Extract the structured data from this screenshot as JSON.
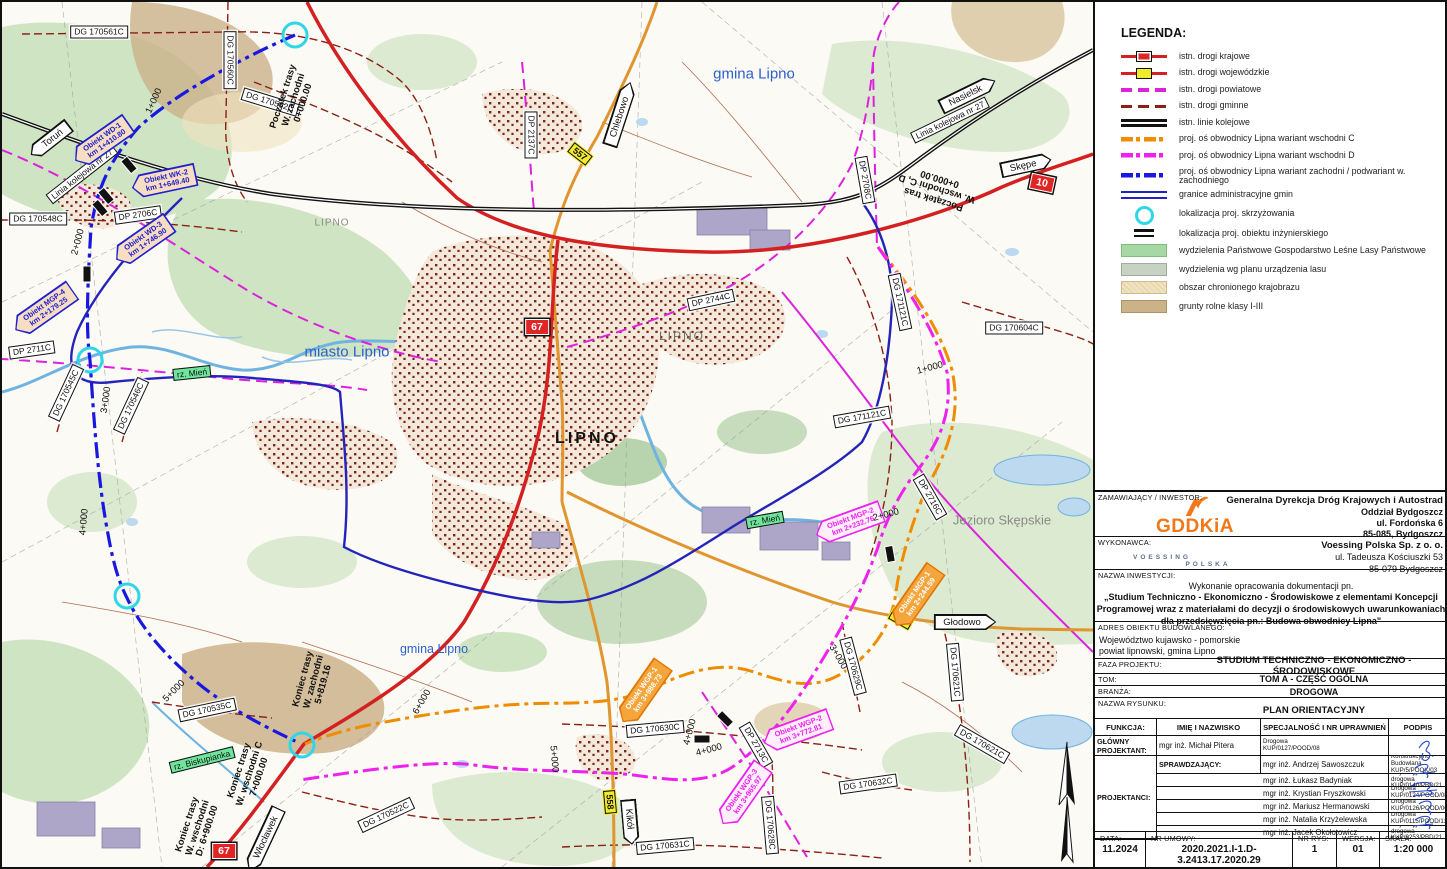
{
  "legend": {
    "title": "LEGENDA:",
    "items": [
      {
        "label": "istn. drogi krajowe"
      },
      {
        "label": "istn. drogi wojewódzkie"
      },
      {
        "label": "istn. drogi powiatowe"
      },
      {
        "label": "istn. drogi gminne"
      },
      {
        "label": "istn. linie kolejowe"
      },
      {
        "label": "proj. oś obwodnicy Lipna wariant wschodni C"
      },
      {
        "label": "proj. oś obwodnicy Lipna wariant wschodni D"
      },
      {
        "label": "proj. oś obwodnicy Lipna wariant zachodni / podwariant w. zachodniego"
      },
      {
        "label": "granice administracyjne gmin"
      },
      {
        "label": "lokalizacja proj. skrzyżowania"
      },
      {
        "label": "lokalizacja proj. obiektu inżynierskiego"
      },
      {
        "label": "wydzielenia Państwowe Gospodarstwo Leśne Lasy Państwowe"
      },
      {
        "label": "wydzielenia wg planu urządzenia lasu"
      },
      {
        "label": "obszar chronionego krajobrazu"
      },
      {
        "label": "grunty rolne klasy I-III"
      }
    ]
  },
  "title_block": {
    "zamawiajacy_label": "ZAMAWIAJĄCY / INWESTOR:",
    "gddkia_logo": "GDDKiA",
    "zamawiajacy_name": "Generalna Dyrekcja Dróg Krajowych i Autostrad",
    "zamawiajacy_addr": "Oddział Bydgoszcz\nul. Fordońska 6\n85-085, Bydgoszcz",
    "wykonawca_label": "WYKONAWCA:",
    "voessing_logo": "VOESSING",
    "voessing_sub": "POLSKA",
    "wykonawca_name": "Voessing Polska Sp. z o. o.",
    "wykonawca_addr": "ul. Tadeusza Kościuszki 53\n85-079 Bydgoszcz",
    "inwestycja_label": "NAZWA INWESTYCJI:",
    "inwestycja_intro": "Wykonanie opracowania dokumentacji pn.",
    "inwestycja_title": "„Studium Techniczno - Ekonomiczno - Środowiskowe z elementami Koncepcji\nProgramowej wraz z materiałami do decyzji o środowiskowych uwarunkowaniach\ndla przedsięwzięcia pn.: Budowa obwodnicy Lipna\"",
    "adres_label": "ADRES OBIEKTU BUDOWLANEGO:",
    "adres_value": "Województwo kujawsko - pomorskie\npowiat lipnowski, gmina Lipno",
    "faza_label": "FAZA PROJEKTU:",
    "faza_value": "STUDIUM TECHNICZNO - EKONOMICZNO - ŚRODOWISKOWE",
    "tom_label": "TOM:",
    "tom_value": "TOM A - CZĘŚĆ OGÓLNA",
    "branza_label": "BRANŻA:",
    "branza_value": "DROGOWA",
    "rysunek_label": "NAZWA RYSUNKU:",
    "rysunek_value": "PLAN ORIENTACYJNY",
    "table": {
      "col_funkcja": "FUNKCJA:",
      "col_name": "IMIĘ I NAZWISKO",
      "col_spec": "SPECJALNOŚĆ I NR UPRAWNIEŃ",
      "col_podpis": "PODPIS",
      "f1": "GŁÓWNY PROJEKTANT:",
      "f2": "SPRAWDZAJĄCY:",
      "f3": "PROJEKTANCI:",
      "rows": [
        {
          "name": "mgr inż. Michał Pitera",
          "spec1": "Drogowa",
          "spec2": "KUP/0127/POOD/08"
        },
        {
          "name": "mgr inż. Andrzej Sawoszczuk",
          "spec1": "Konstrukcyjno - Budowlana",
          "spec2": "KUP/5/POOK/03"
        },
        {
          "name": "mgr inż. Łukasz Badyniak",
          "spec1": "Inżynieryjna drogowa",
          "spec2": "KUP/0140/PBD/21"
        },
        {
          "name": "mgr inż. Krystian Fryszkowski",
          "spec1": "Drogowa",
          "spec2": "KUP/0124/POOD/08"
        },
        {
          "name": "mgr inż. Mariusz Hermanowski",
          "spec1": "Drogowa",
          "spec2": "KUP/0126/POOD/06"
        },
        {
          "name": "mgr inż. Natalia Krzyżelewska",
          "spec1": "Drogowa",
          "spec2": "KUP/0115/POOD/13"
        },
        {
          "name": "mgr inż. Jacek Okołotowicz",
          "spec1": "Inżynieryjna drogowa",
          "spec2": "KUP/0253/PBD/21"
        }
      ]
    },
    "bottom": {
      "data_label": "DATA:",
      "data_value": "11.2024",
      "umowa_label": "NR UMOWY:",
      "umowa_value": "2020.2021.I-1.D-3.2413.17.2020.29",
      "rys_label": "NR RYS:",
      "rys_value": "1",
      "wersja_label": "WERSJA:",
      "wersja_value": "01",
      "skala_label": "SKALA:",
      "skala_value": "1:20 000"
    }
  },
  "map": {
    "area_labels": [
      {
        "text": "gmina Lipno"
      },
      {
        "text": "gmina Lipno"
      },
      {
        "text": "miasto Lipno"
      },
      {
        "text": "Jezioro Skępskie"
      },
      {
        "text": "LIPNO"
      },
      {
        "text": "LIPNO"
      },
      {
        "text": "LIPNO"
      }
    ],
    "river_labels": [
      {
        "text": "rz. Mień"
      },
      {
        "text": "rz. Mień"
      },
      {
        "text": "rz. Biskupianka"
      }
    ],
    "rail_labels": [
      {
        "text": "Linia kolejowa nr 27"
      },
      {
        "text": "Linia kolejowa nr 27"
      }
    ],
    "arrows": [
      {
        "text": "Toruń"
      },
      {
        "text": "Nasielsk"
      },
      {
        "text": "Skępe"
      },
      {
        "text": "Chlebowo"
      },
      {
        "text": "Głodowo"
      },
      {
        "text": "Włocławek"
      },
      {
        "text": "Kikół"
      }
    ],
    "shields": [
      {
        "num": "67"
      },
      {
        "num": "67"
      },
      {
        "num": "10"
      },
      {
        "num": "557"
      },
      {
        "num": "558"
      },
      {
        "num": "559"
      }
    ],
    "road_labels": [
      {
        "text": "DG 170561C"
      },
      {
        "text": "DG 170560C"
      },
      {
        "text": "DG 170562C"
      },
      {
        "text": "DG 170548C"
      },
      {
        "text": "DP 2706C"
      },
      {
        "text": "DP 2711C"
      },
      {
        "text": "DG 170545C"
      },
      {
        "text": "DG 170546C"
      },
      {
        "text": "DP 2137C"
      },
      {
        "text": "DP 2744C"
      },
      {
        "text": "DG 170604C"
      },
      {
        "text": "DG 171121C"
      },
      {
        "text": "DG 171121C"
      },
      {
        "text": "DP 2708C"
      },
      {
        "text": "DG 170535C"
      },
      {
        "text": "DG 170522C"
      },
      {
        "text": "DG 170630C"
      },
      {
        "text": "DG 170631C"
      },
      {
        "text": "DG 170628C"
      },
      {
        "text": "DP 2713C"
      },
      {
        "text": "DP 2716C"
      },
      {
        "text": "DG 170629C"
      },
      {
        "text": "DG 170621C"
      },
      {
        "text": "DG 170621C"
      },
      {
        "text": "DG 170632C"
      }
    ],
    "objects": [
      {
        "name": "Obiekt WD-1",
        "km": "km 1+410.80"
      },
      {
        "name": "Obiekt WK-2",
        "km": "km 1+649.40"
      },
      {
        "name": "Obiekt WD-3",
        "km": "km 1+746.90"
      },
      {
        "name": "Obiekt MGP-4",
        "km": "km 2+179.25"
      },
      {
        "name": "Obiekt WGP-2",
        "km": "km 3+772.81"
      },
      {
        "name": "Obiekt WGP-3",
        "km": "km 3+965.97"
      },
      {
        "name": "Obiekt MGP-2",
        "km": "km 2+232.76"
      },
      {
        "name": "Obiekt MGP-1",
        "km": "km 2+244.59"
      },
      {
        "name": "Obiekt WGP-1",
        "km": "km 3+988.73"
      }
    ],
    "km_markers": [
      {
        "text": "1+000"
      },
      {
        "text": "2+000"
      },
      {
        "text": "3+000"
      },
      {
        "text": "4+000"
      },
      {
        "text": "5+000"
      },
      {
        "text": "1+000"
      },
      {
        "text": "2+000"
      },
      {
        "text": "3+000"
      },
      {
        "text": "4+000"
      },
      {
        "text": "4+000"
      },
      {
        "text": "5+000"
      },
      {
        "text": "6+000"
      }
    ],
    "endpoints": [
      {
        "l1": "Początek trasy",
        "l2": "W. zachodni",
        "l3": "0+000.00"
      },
      {
        "l1": "Początek tras",
        "l2": "W. wschodni C, D",
        "l3": "0+000.00"
      },
      {
        "l1": "Koniec trasy",
        "l2": "W. zachodni",
        "l3": "5+819.16"
      },
      {
        "l1": "Koniec trasy",
        "l2": "W. wschodni C",
        "l3": "7+000.00"
      },
      {
        "l1": "Koniec trasy",
        "l2": "W. wschodni",
        "l3": "D: 6+900.00"
      }
    ],
    "colors": {
      "droga_krajowa": "#d42020",
      "droga_wojewodzka": "#e0952f",
      "droga_powiatowa": "#dd22dd",
      "droga_gminna": "#8b2015",
      "linia_kolejowa": "#111111",
      "wariant_c": "#f08c00",
      "wariant_d": "#ee22ee",
      "wariant_zachodni": "#1818e0",
      "granice": "#2424bb",
      "skrzyzowanie": "#2fd6e8",
      "las": "#cfe4c3",
      "obszar_chroniony": "#f0e2c0",
      "grunty_rolne": "#cbb289",
      "woda": "#8fc1e8"
    }
  }
}
